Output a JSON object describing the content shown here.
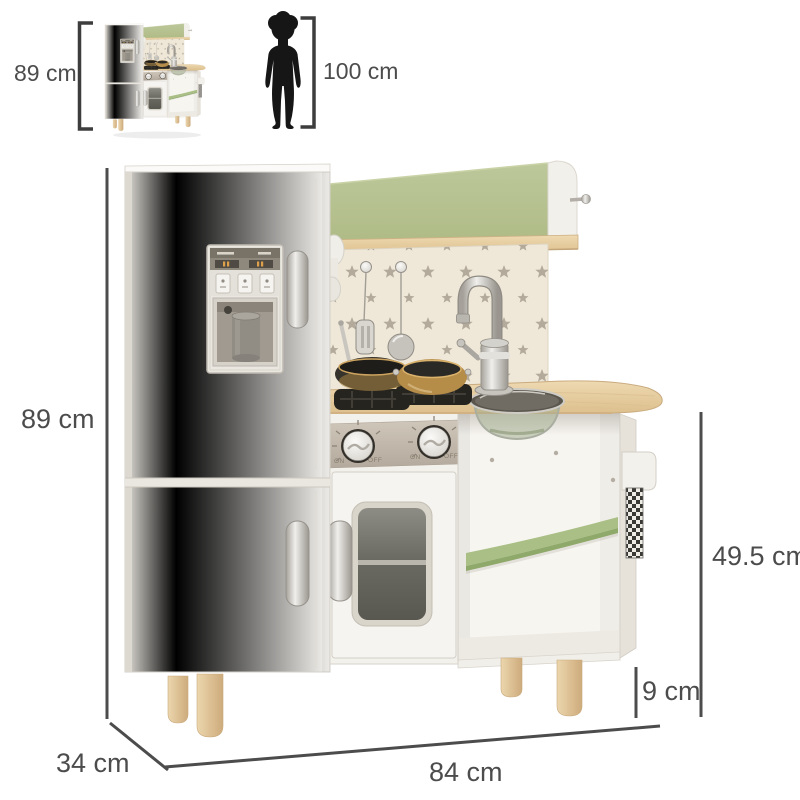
{
  "figure": {
    "background": "#ffffff",
    "annotation_color": "#4c4c4c"
  },
  "reference_row": {
    "product_thumbnail": {
      "height_label": "89 cm"
    },
    "child_reference": {
      "height_label": "100 cm"
    }
  },
  "dimensions": {
    "overall_height": "89 cm",
    "counter_section_height": "49.5 cm",
    "leg_height": "9 cm",
    "overall_width": "84 cm",
    "depth": "34 cm"
  },
  "product": {
    "type": "kids-play-kitchen",
    "stove_knobs": {
      "on_label": "ON",
      "off_label": "OFF"
    },
    "colors": {
      "panel_green": "#b7c392",
      "shelf_green": "#a9bf85",
      "counter_wood": "#e8d1a6",
      "leg_wood": "#e0c498",
      "body_white": "#f3f1ec",
      "backsplash_cream": "#efe8d8",
      "star_gray": "#b4aa9b",
      "control_panel_taupe": "#c3b9ac",
      "hardware_silver": "#c9c6c0"
    },
    "features": [
      "ice-dispenser",
      "refrigerator-doors",
      "stove-burners",
      "oven-window-door",
      "gooseneck-faucet",
      "sink-basin",
      "corner-shelf",
      "towel-rail",
      "hanging-utensils",
      "star-backsplash"
    ]
  }
}
